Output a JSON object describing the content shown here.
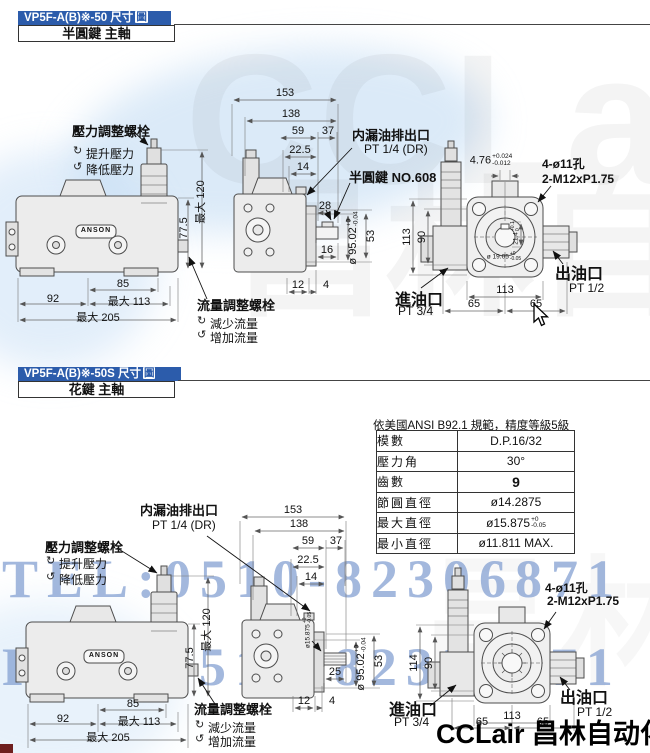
{
  "watermarks": {
    "tel": "TEL:0510-82306871",
    "fax": "FAX:0510-82328871",
    "brand": "CCLair 昌林自动化",
    "giant_latin": "CCLair",
    "giant_cjk": "昌林自动化"
  },
  "icons": {
    "cw": "↻",
    "ccw": "↺"
  },
  "section1": {
    "title": "VP5F-A(B)※-50 尺寸",
    "title_box": "圖",
    "subtitle": "半圓鍵  主軸",
    "labels": {
      "pressure_bolt": "壓力調整螺栓",
      "raise": "提升壓力",
      "lower": "降低壓力",
      "flow_bolt": "流量調整螺栓",
      "decrease": "減少流量",
      "increase": "增加流量",
      "drain": "内漏油排出口",
      "drain_pt": "PT 1/4 (DR)",
      "key": "半圓鍵  NO.608",
      "inlet": "進油口",
      "inlet_pt": "PT 3/4",
      "outlet": "出油口",
      "outlet_pt": "PT 1/2",
      "holes": "4-ø11孔",
      "thread": "2-M12xP1.75",
      "brand_plate": "ANSON"
    },
    "dims": {
      "d153": "153",
      "d138": "138",
      "d59": "59",
      "d37": "37",
      "d22_5": "22.5",
      "d14": "14",
      "d28": "28",
      "d16": "16",
      "d12": "12",
      "d4": "4",
      "d53": "53",
      "d77_5": "77.5",
      "dmax120": "最大 120",
      "d85": "85",
      "d92": "92",
      "dmax113": "最大 113",
      "dmax205": "最大 205",
      "d95": "ø 95.02",
      "d95_tol_top": "+0",
      "d95_tol_bot": "-0.04",
      "d476": "4.76",
      "d476_tol_top": "+0.024",
      "d476_tol_bot": "-0.012",
      "d113v": "113",
      "d90": "90",
      "d21_4": "21.4",
      "d21_4_tol_top": "+0.1",
      "d21_4_tol_bot": "0",
      "d19": "ø 19.05",
      "d19_tol_top": "+0",
      "d19_tol_bot": "-0.05",
      "d113b": "113",
      "d65a": "65",
      "d65b": "65"
    }
  },
  "section2": {
    "title": "VP5F-A(B)※-50S 尺寸",
    "title_box": "圖",
    "subtitle": "花鍵  主軸",
    "table": {
      "caption": "依美國ANSI  B92.1 規範，精度等級5級",
      "rows": [
        {
          "k": "模數",
          "v": "D.P.16/32"
        },
        {
          "k": "壓力角",
          "v": "30°"
        },
        {
          "k": "齒數",
          "v": "9"
        },
        {
          "k": "節圓直徑",
          "v": "ø14.2875"
        },
        {
          "k": "最大直徑",
          "v": "ø15.875",
          "tol_top": "+0",
          "tol_bot": "-0.05"
        },
        {
          "k": "最小直徑",
          "v": "ø11.811 MAX."
        }
      ]
    },
    "labels": {
      "pressure_bolt": "壓力調整螺栓",
      "raise": "提升壓力",
      "lower": "降低壓力",
      "flow_bolt": "流量調整螺栓",
      "decrease": "減少流量",
      "increase": "增加流量",
      "drain": "内漏油排出口",
      "drain_pt": "PT 1/4 (DR)",
      "inlet": "進油口",
      "inlet_pt": "PT 3/4",
      "outlet": "出油口",
      "outlet_pt": "PT 1/2",
      "holes": "4-ø11孔",
      "thread": "2-M12xP1.75",
      "brand_plate": "ANSON"
    },
    "dims": {
      "d153": "153",
      "d138": "138",
      "d59": "59",
      "d37": "37",
      "d22_5": "22.5",
      "d14": "14",
      "d25": "25",
      "d12": "12",
      "d4": "4",
      "d53": "53",
      "d77_5": "77.5",
      "dmax120": "最大 120",
      "d85": "85",
      "d92": "92",
      "dmax113": "最大 113",
      "dmax205": "最大 205",
      "d95": "ø 95.02",
      "d95_tol_top": "+0",
      "d95_tol_bot": "-0.04",
      "d15875": "ø15.875",
      "d15875_tol_top": "+0",
      "d15875_tol_bot": "-0.05",
      "d114v": "114",
      "d90": "90",
      "d113b": "113",
      "d65a": "65",
      "d65b": "65"
    }
  }
}
